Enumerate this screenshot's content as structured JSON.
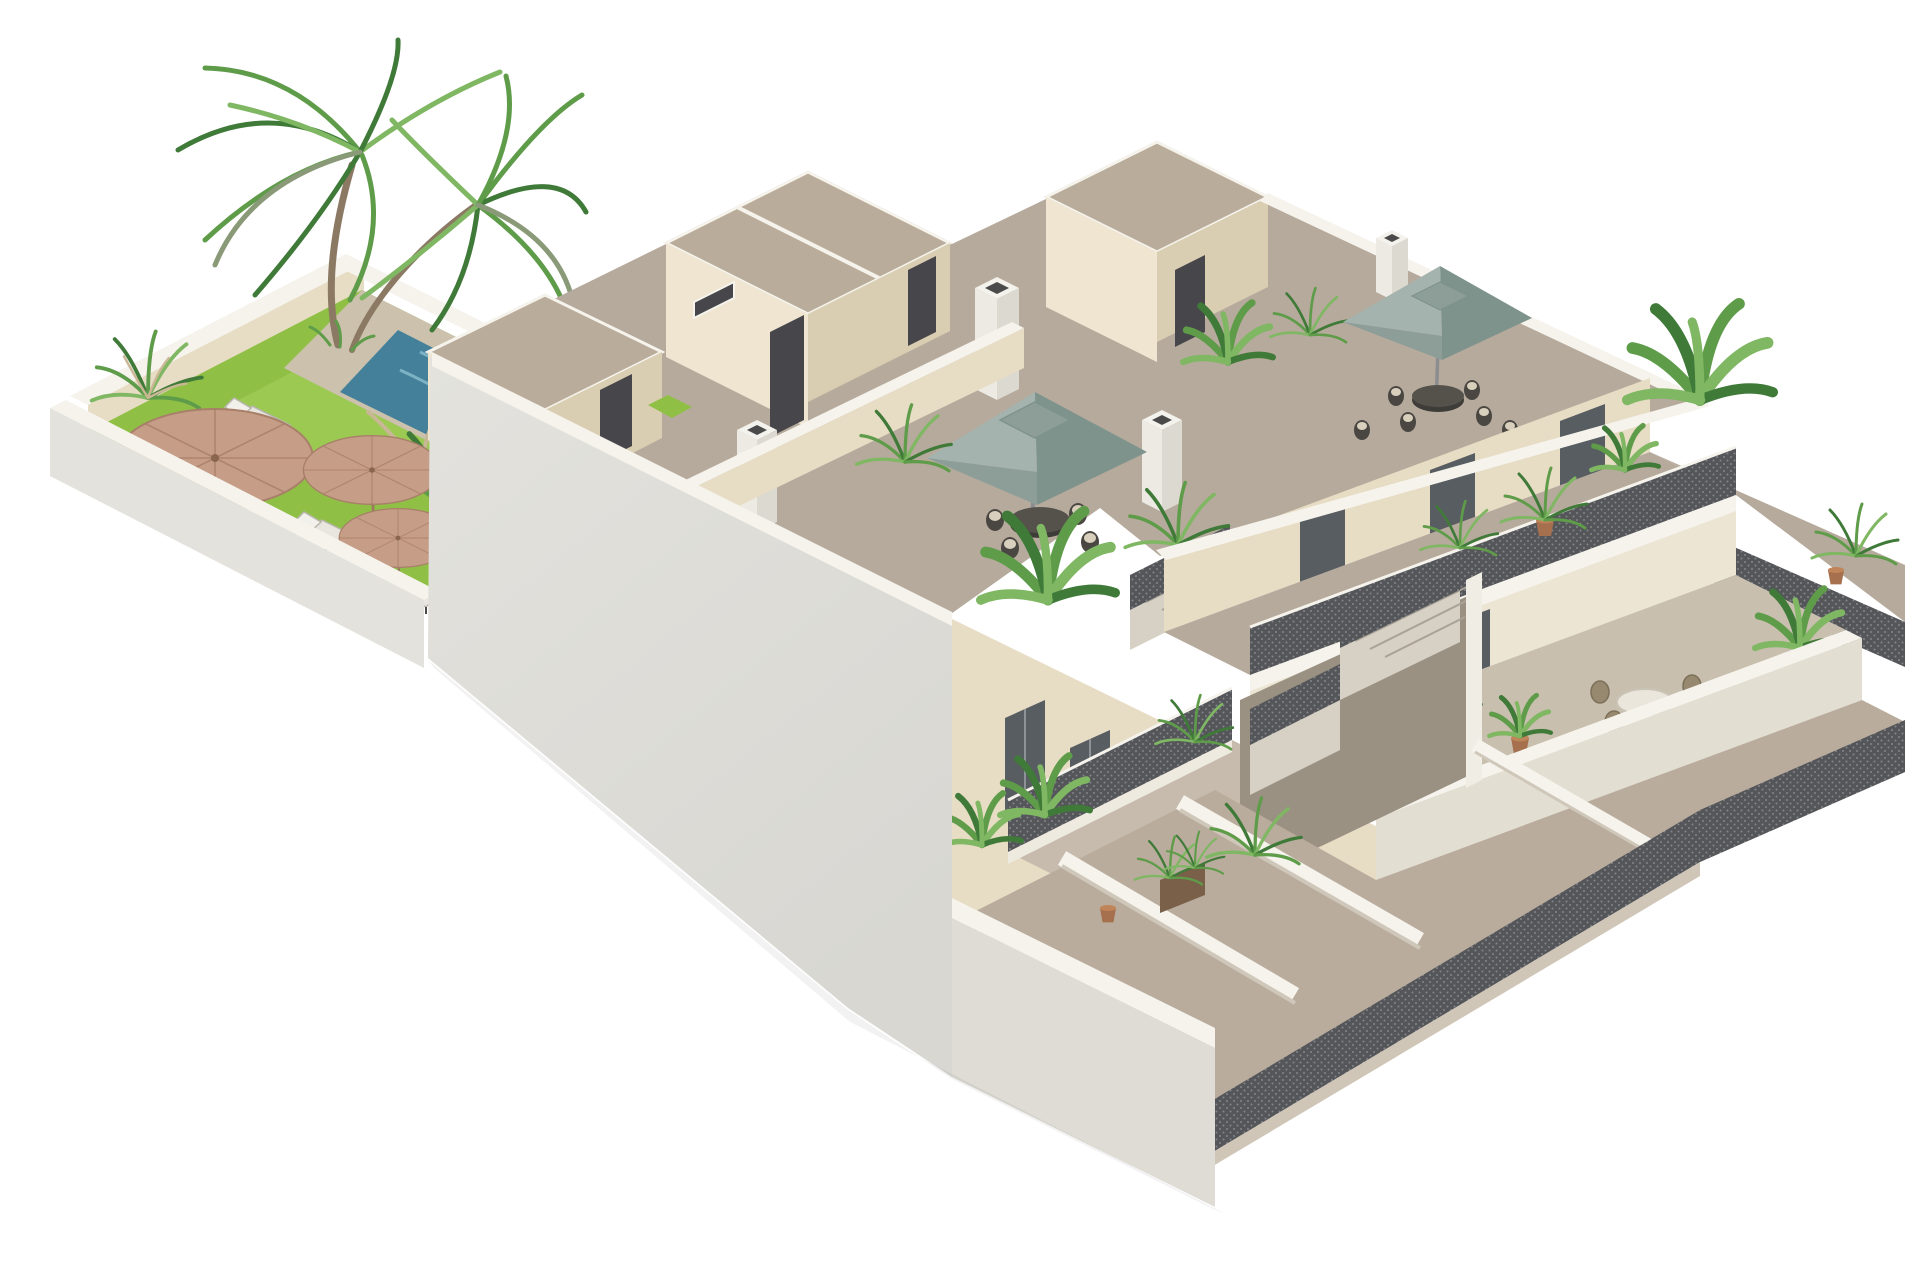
{
  "meta": {
    "title": "Isometric 3D architectural rendering",
    "type": "3D cutaway render of a residential building"
  },
  "scene": {
    "description": "Isometric 3D cutaway rendering of a three-storey white and cream apartment building with two rooftop terraces shaded by square sage-green parasols, open lattice-railed balconies, a central open metal staircase, ground-floor terraces behind dark perimeter fences, and a walled garden on the left containing a swimming pool, bright green lawn, three straw parasols, white sun loungers and a twin-trunk palm tree.",
    "garden": {
      "lawn": true,
      "swimming_pool": true,
      "straw_parasols": 3,
      "sun_loungers": 5,
      "palm_trunks": 2,
      "pampas_plants": 3
    },
    "building": {
      "storeys": 3,
      "roof_terraces": 2,
      "sage_parasols": 2,
      "outdoor_dining_sets": 3,
      "stair_bulkheads": 3,
      "chimneys": 4,
      "lattice_balcony_railings": true,
      "central_staircase_flights": 3,
      "ground_floor_terraces": 4,
      "perimeter_fence": true,
      "potted_plants": "many"
    }
  },
  "palette": {
    "bg": "#ffffff",
    "lawn": "#8fc045",
    "lawn_light": "#a5cf5d",
    "pool": "#45809a",
    "pool_light": "#8fc3d2",
    "deck": "#cbc1ac",
    "white_band": "#f5f3ec",
    "cream": "#e7dcc4",
    "cream_light": "#efe5d1",
    "cream_dark": "#d9cdb2",
    "floor": "#b6aa9c",
    "floor_light": "#c6bbac",
    "ground": "#b9ac9d",
    "beige_terr": "#c9bfae",
    "gray_wall": "#d8d7d2",
    "gray_wall_light": "#e3e2dd",
    "front_wall": "#dedcd4",
    "tan_roof": "#b9ac9b",
    "door": "#47474b",
    "glass": "#585d61",
    "metal": "#54565a",
    "metal_dot": "#83858a",
    "teal_light": "#a4b3ad",
    "teal_dark": "#7f938d",
    "teal_cap": "#8d9e99",
    "green_dark": "#3f7a38",
    "green_mid": "#5f9c4a",
    "green_light": "#7fb763",
    "dry_grass": "#c9b795",
    "straw": "#c69d87",
    "straw_dark": "#a87f69",
    "trunk": "#8b7964",
    "terracotta": "#a66f4e",
    "table_dark": "#3e3c38",
    "wicker": "#97896f",
    "lounger": "#e8e6df",
    "tread": "#d7d1c5",
    "shadow_wall": "#9a9183"
  }
}
